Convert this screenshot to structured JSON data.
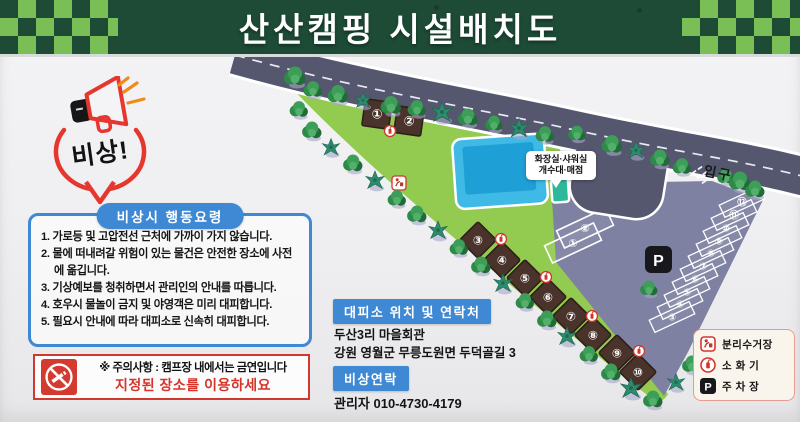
{
  "header": {
    "title": "산산캠핑 시설배치도"
  },
  "emblem": {
    "label": "비상!"
  },
  "guidelines": {
    "title": "비상시 행동요령",
    "items": [
      "1. 가로등 및 고압전선 근처에 가까이 가지 않습니다.",
      "2. 물에 떠내려갈 위험이 있는 물건은 안전한 장소에 사전에 옮깁니다.",
      "3. 기상예보를 청취하면서 관리인의 안내를 따릅니다.",
      "4. 호우시 물놀이 금지 및 야영객은 미리 대피합니다.",
      "5. 필요시 안내에 따라 대피소로 신속히 대피합니다."
    ]
  },
  "smoking_notice": {
    "line1": "※ 주의사항 : 캠프장 내에서는 금연입니다",
    "line2": "지정된 장소를 이용하세요"
  },
  "shelter": {
    "badge": "대피소 위치 및 연락처",
    "lines": [
      "두산3리 마을회관",
      "강원 영월군 무릉도원면 두덕골길 3"
    ]
  },
  "contact": {
    "badge": "비상연락",
    "line": "관리자 010-4730-4179"
  },
  "legend": {
    "parking_symbol": "P",
    "items": [
      {
        "icon": "recycle-station-icon",
        "label": "분리수거장"
      },
      {
        "icon": "fire-extinguisher-icon",
        "label": "소 화 기"
      },
      {
        "icon": "parking-icon",
        "label": "주 차 장"
      }
    ]
  },
  "map": {
    "entrance_label": "입구",
    "parking_symbol": "P",
    "facility_bubble": [
      "화장실·샤워실",
      "개수대·매점"
    ],
    "sites": [
      {
        "n": 1,
        "x": 377,
        "y": 114,
        "shape": "square"
      },
      {
        "n": 2,
        "x": 409,
        "y": 121,
        "shape": "square"
      },
      {
        "n": 3,
        "x": 478,
        "y": 240,
        "shape": "diamond"
      },
      {
        "n": 4,
        "x": 502,
        "y": 260,
        "shape": "diamond"
      },
      {
        "n": 5,
        "x": 525,
        "y": 278,
        "shape": "diamond"
      },
      {
        "n": 6,
        "x": 548,
        "y": 297,
        "shape": "diamond"
      },
      {
        "n": 7,
        "x": 571,
        "y": 316,
        "shape": "diamond"
      },
      {
        "n": 8,
        "x": 593,
        "y": 335,
        "shape": "diamond"
      },
      {
        "n": 9,
        "x": 617,
        "y": 353,
        "shape": "diamond"
      },
      {
        "n": 10,
        "x": 638,
        "y": 372,
        "shape": "diamond"
      }
    ],
    "parking_stalls": [
      {
        "n": 1,
        "x": 573,
        "y": 243,
        "big": true
      },
      {
        "n": 2,
        "x": 585,
        "y": 228,
        "big": true
      },
      {
        "n": 3,
        "x": 672,
        "y": 317
      },
      {
        "n": 4,
        "x": 680,
        "y": 304
      },
      {
        "n": 5,
        "x": 687,
        "y": 292
      },
      {
        "n": 6,
        "x": 695,
        "y": 279
      },
      {
        "n": 7,
        "x": 703,
        "y": 266
      },
      {
        "n": 8,
        "x": 711,
        "y": 253
      },
      {
        "n": 9,
        "x": 719,
        "y": 241
      },
      {
        "n": 10,
        "x": 726,
        "y": 228
      },
      {
        "n": 11,
        "x": 734,
        "y": 215
      },
      {
        "n": 12,
        "x": 742,
        "y": 202
      }
    ],
    "extinguisher_markers": [
      [
        390,
        131
      ],
      [
        501,
        239
      ],
      [
        546,
        277
      ],
      [
        592,
        316
      ],
      [
        639,
        351
      ]
    ],
    "recycle_marker": [
      399,
      183
    ],
    "entrance_marks": [
      [
        694,
        172
      ],
      [
        699,
        177
      ],
      [
        704,
        182
      ],
      [
        700,
        168
      ],
      [
        705,
        173
      ],
      [
        710,
        178
      ]
    ],
    "trees": [
      [
        295,
        77,
        1,
        "r"
      ],
      [
        313,
        90,
        0.85,
        "r"
      ],
      [
        338,
        95,
        0.95,
        "r"
      ],
      [
        363,
        101,
        0.8,
        "p"
      ],
      [
        391,
        106,
        0.95,
        "r"
      ],
      [
        417,
        109,
        0.85,
        "r"
      ],
      [
        442,
        113,
        1,
        "p"
      ],
      [
        468,
        118,
        0.9,
        "r"
      ],
      [
        494,
        124,
        0.8,
        "r"
      ],
      [
        519,
        129,
        0.95,
        "p"
      ],
      [
        545,
        135,
        0.85,
        "r"
      ],
      [
        577,
        134,
        0.8,
        "r"
      ],
      [
        612,
        145,
        0.95,
        "r"
      ],
      [
        636,
        151,
        0.85,
        "p"
      ],
      [
        660,
        159,
        0.9,
        "r"
      ],
      [
        682,
        167,
        0.85,
        "r"
      ],
      [
        726,
        177,
        0.8,
        "r"
      ],
      [
        740,
        182,
        1,
        "r"
      ],
      [
        755,
        190,
        0.9,
        "r"
      ],
      [
        299,
        110,
        0.85,
        "r"
      ],
      [
        312,
        131,
        0.9,
        "r"
      ],
      [
        331,
        148,
        0.85,
        "p"
      ],
      [
        353,
        164,
        0.9,
        "r"
      ],
      [
        375,
        181,
        0.9,
        "p"
      ],
      [
        397,
        199,
        0.85,
        "r"
      ],
      [
        417,
        215,
        0.9,
        "r"
      ],
      [
        438,
        231,
        0.9,
        "p"
      ],
      [
        459,
        248,
        0.85,
        "r"
      ],
      [
        481,
        266,
        0.9,
        "r"
      ],
      [
        503,
        284,
        0.9,
        "p"
      ],
      [
        525,
        302,
        0.85,
        "r"
      ],
      [
        547,
        320,
        0.9,
        "r"
      ],
      [
        567,
        337,
        0.9,
        "p"
      ],
      [
        589,
        355,
        0.85,
        "r"
      ],
      [
        611,
        373,
        0.9,
        "r"
      ],
      [
        631,
        389,
        1,
        "p"
      ],
      [
        653,
        400,
        0.9,
        "r"
      ],
      [
        649,
        289,
        0.8,
        "r"
      ],
      [
        692,
        365,
        0.9,
        "r"
      ],
      [
        676,
        383,
        0.85,
        "p"
      ]
    ]
  },
  "colors": {
    "banner_green": "#1d4b36",
    "checker_green": "#7abf55",
    "grass": "#92cb4f",
    "road": "#55576f",
    "parking": "#7e81a1",
    "pool_outer": "#3fb9e6",
    "pool_inner": "#1e9fd6",
    "building": "#2eb89b",
    "campsite_brown": "#4a332b",
    "accent_blue": "#3f88d4",
    "accent_red": "#d6342b"
  }
}
